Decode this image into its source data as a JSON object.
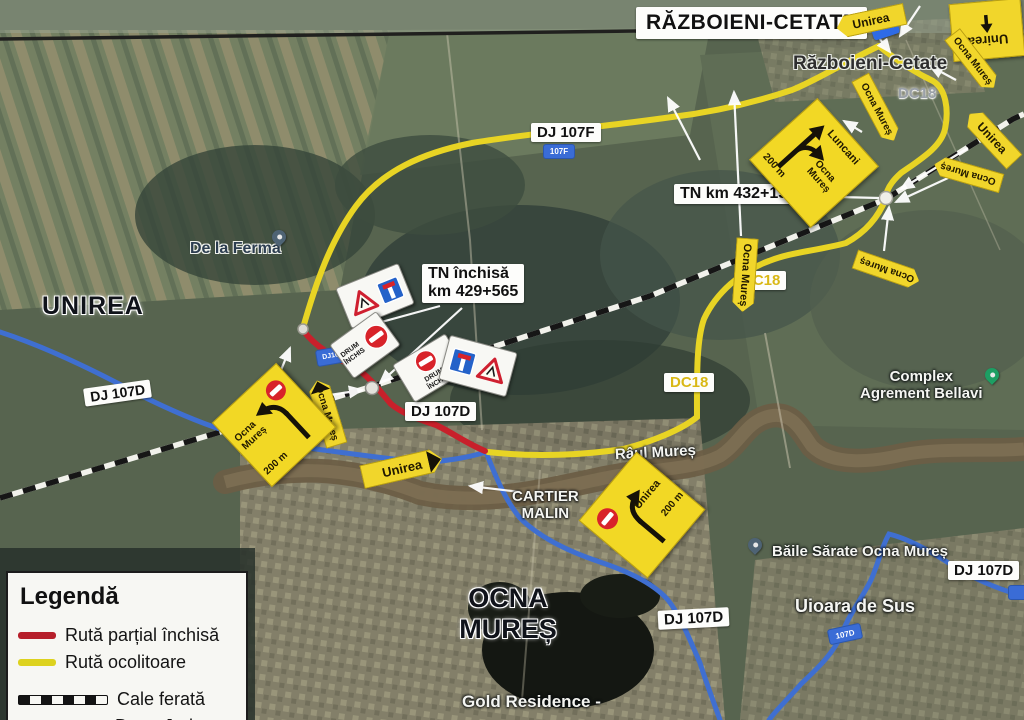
{
  "legend": {
    "title": "Legendă",
    "partial_closed": "Rută parțial închisă",
    "detour": "Rută ocolitoare",
    "railway": "Cale ferată",
    "county_road": "Drum Județean",
    "county_road_code": "DJ 107D"
  },
  "places": {
    "razboieni_title": "RĂZBOIENI-CETATE",
    "razboieni": "Războieni-Cetate",
    "unirea_town": "UNIREA",
    "de_la_ferma": "De la Ferma",
    "ocna_line1": "OCNA",
    "ocna_line2": "MUREȘ",
    "raul_mures": "Râul Mureș",
    "baile_sarate": "Băile Sărate Ocna Mureș",
    "uioara": "Uioara de Sus",
    "complex_line1": "Complex",
    "complex_line2": "Agrement Bellavi",
    "gold_residence": "Gold Residence -",
    "cartier_line1": "CARTIER",
    "cartier_line2": "MALIN"
  },
  "roads": {
    "dj107f": "DJ 107F",
    "dj107d": "DJ 107D",
    "dc18": "DC18",
    "shield_107f": "107F",
    "shield_dj107d": "DJ107D",
    "shield_107d": "107D"
  },
  "annotations": {
    "tn_closed_line1": "TN închisă",
    "tn_closed_line2": "km 429+565",
    "tn_open": "TN km 432+159"
  },
  "signs": {
    "unirea": "Unirea",
    "ocna_mures": "Ocna Mureș",
    "luncani": "Luncani",
    "dist_200m": "200 m",
    "drum_line1": "DRUM",
    "drum_line2": "ÎNCHIS"
  },
  "colors": {
    "closed_route": "#c8202b",
    "detour_route": "#e8d424",
    "county_road": "#3f6fd1",
    "sign_yellow": "#f2d825"
  }
}
